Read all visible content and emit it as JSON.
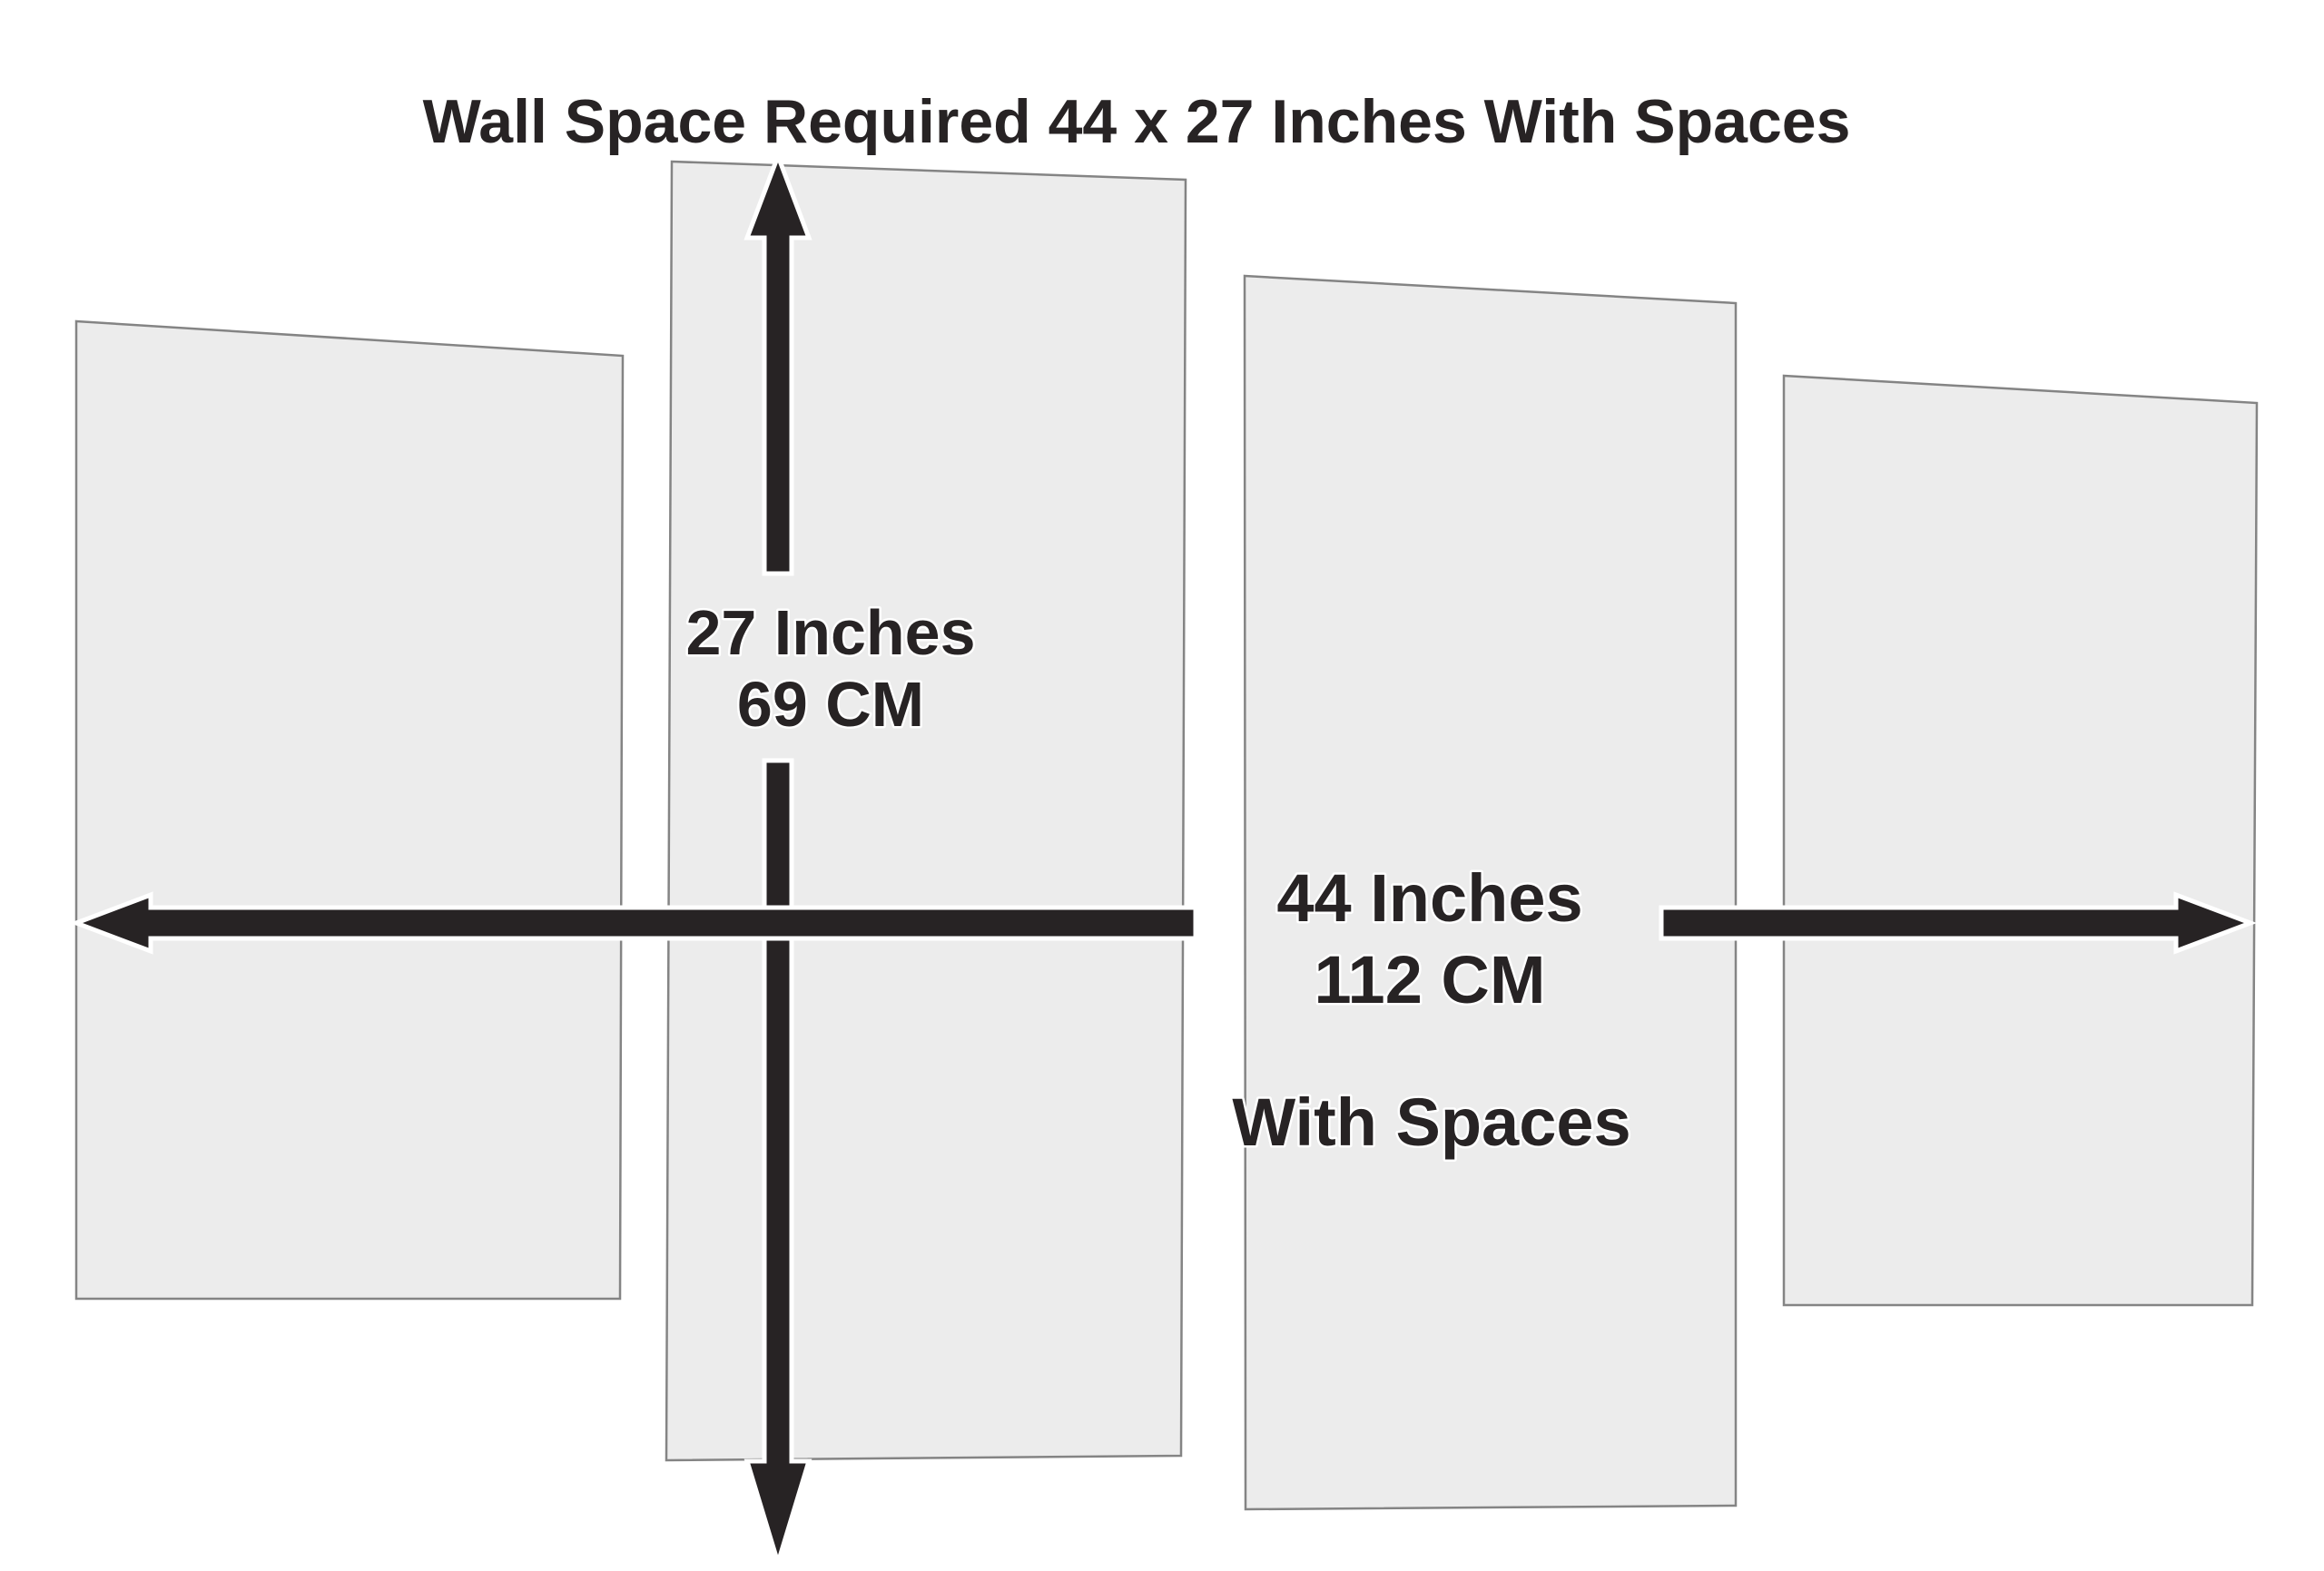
{
  "title": "Wall Space Required 44 x 27 Inches With Spaces",
  "vertical_dimension": {
    "line1": "27 Inches",
    "line2": "69 CM"
  },
  "horizontal_dimension": {
    "line1": "44 Inches",
    "line2": "112 CM",
    "note": "With Spaces"
  },
  "panels": {
    "count": 4
  },
  "icons": {
    "vertical_arrow": "double-headed-vertical-arrow",
    "horizontal_arrow": "double-headed-horizontal-arrow"
  },
  "colors": {
    "background": "#ffffff",
    "panel_fill": "#ececec",
    "panel_stroke": "#848484",
    "arrow_color": "#272324",
    "text_color": "#272324",
    "halo_color": "#ffffff"
  }
}
